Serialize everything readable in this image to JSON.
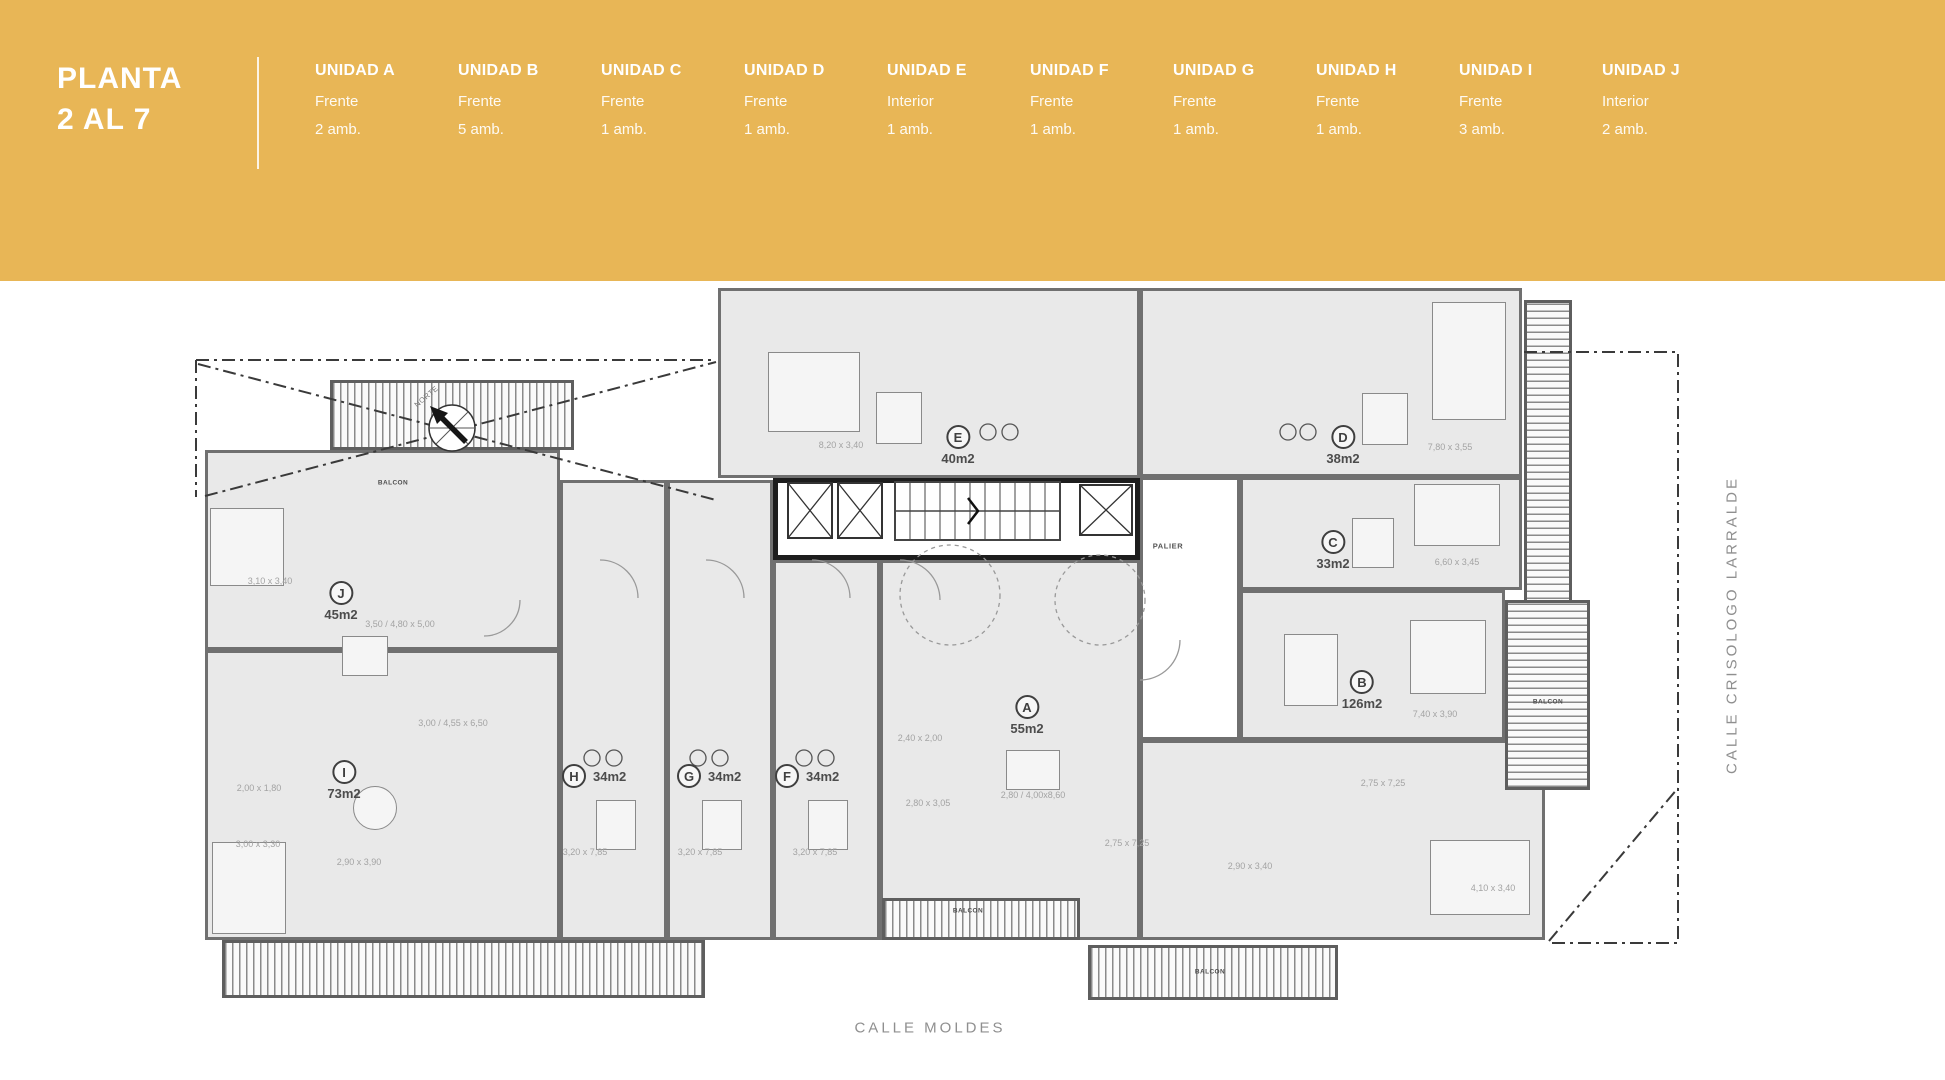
{
  "header": {
    "title_line1": "PLANTA",
    "title_line2": "2 AL 7",
    "units": [
      {
        "name": "UNIDAD A",
        "orientation": "Frente",
        "rooms": "2 amb."
      },
      {
        "name": "UNIDAD B",
        "orientation": "Frente",
        "rooms": "5 amb."
      },
      {
        "name": "UNIDAD C",
        "orientation": "Frente",
        "rooms": "1 amb."
      },
      {
        "name": "UNIDAD D",
        "orientation": "Frente",
        "rooms": "1 amb."
      },
      {
        "name": "UNIDAD E",
        "orientation": "Interior",
        "rooms": "1 amb."
      },
      {
        "name": "UNIDAD F",
        "orientation": "Frente",
        "rooms": "1 amb."
      },
      {
        "name": "UNIDAD G",
        "orientation": "Frente",
        "rooms": "1 amb."
      },
      {
        "name": "UNIDAD H",
        "orientation": "Frente",
        "rooms": "1 amb."
      },
      {
        "name": "UNIDAD I",
        "orientation": "Frente",
        "rooms": "3 amb."
      },
      {
        "name": "UNIDAD J",
        "orientation": "Interior",
        "rooms": "2 amb."
      }
    ]
  },
  "plan": {
    "compass": "NORTE",
    "palier": "PALIER",
    "balcon": "BALCON",
    "streets": {
      "bottom": "CALLE MOLDES",
      "right": "CALLE CRISOLOGO LARRALDE"
    },
    "unit_labels": [
      {
        "letter": "A",
        "area": "55m2"
      },
      {
        "letter": "B",
        "area": "126m2"
      },
      {
        "letter": "C",
        "area": "33m2"
      },
      {
        "letter": "D",
        "area": "38m2"
      },
      {
        "letter": "E",
        "area": "40m2"
      },
      {
        "letter": "F",
        "area": "34m2"
      },
      {
        "letter": "G",
        "area": "34m2"
      },
      {
        "letter": "H",
        "area": "34m2"
      },
      {
        "letter": "I",
        "area": "73m2"
      },
      {
        "letter": "J",
        "area": "45m2"
      }
    ],
    "dimensions": [
      {
        "text": "8,20 x 3,40"
      },
      {
        "text": "7,80 x 3,55"
      },
      {
        "text": "6,60 x 3,45"
      },
      {
        "text": "7,40 x 3,90"
      },
      {
        "text": "2,75 x 7,25"
      },
      {
        "text": "3,10 x 3,40"
      },
      {
        "text": "3,50 / 4,80 x 5,00"
      },
      {
        "text": "3,00 / 4,55 x 6,50"
      },
      {
        "text": "2,00 x 1,80"
      },
      {
        "text": "3,00 x 3,30"
      },
      {
        "text": "2,90 x 3,90"
      },
      {
        "text": "3,20 x 7,85"
      },
      {
        "text": "3,20 x 7,85"
      },
      {
        "text": "3,20 x 7,85"
      },
      {
        "text": "2,40 x 2,00"
      },
      {
        "text": "2,80 x 3,05"
      },
      {
        "text": "2,80 / 4,00x8,60"
      },
      {
        "text": "2,75 x 7,25"
      },
      {
        "text": "2,90 x 3,40"
      },
      {
        "text": "4,10 x 3,40"
      }
    ]
  },
  "colors": {
    "band_yellow": "#E8B656",
    "wall_gray": "#707070",
    "room_fill": "#E9E9E9",
    "dim_text": "#A3A3A3",
    "street_text": "#8F8F8F"
  }
}
